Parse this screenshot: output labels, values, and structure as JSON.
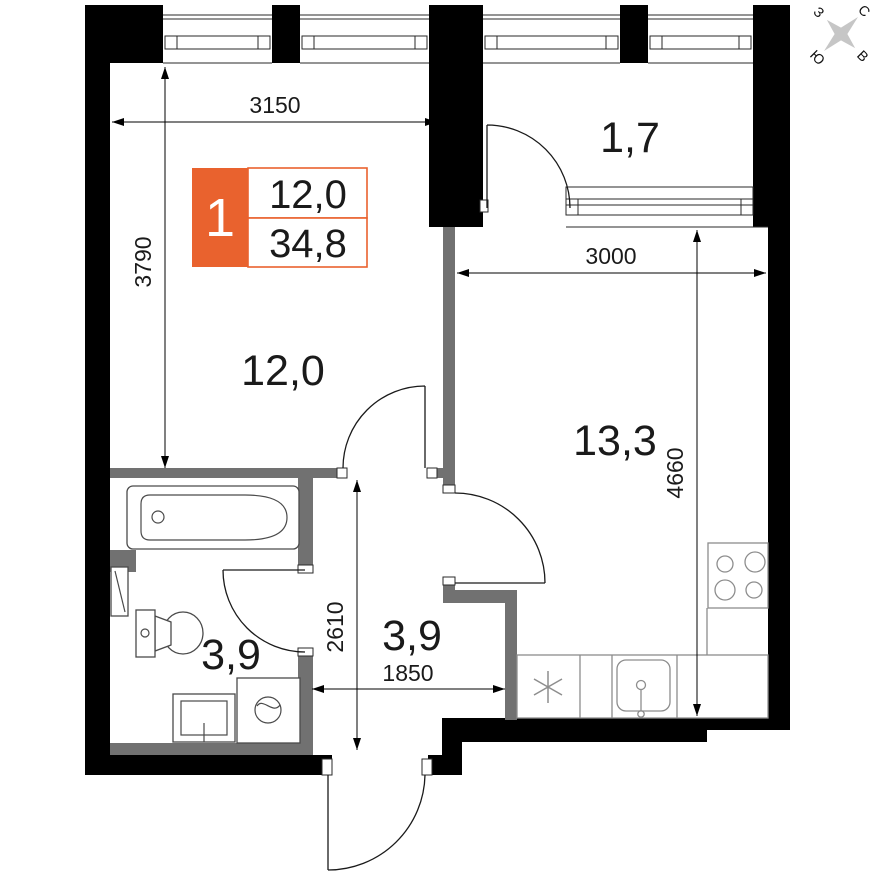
{
  "plan": {
    "legend": {
      "flat_number": "1",
      "living_area": "12,0",
      "total_area": "34,8"
    },
    "rooms": {
      "living": {
        "label": "12,0"
      },
      "kitchen_living": {
        "label": "13,3"
      },
      "loggia": {
        "label": "1,7"
      },
      "bathroom": {
        "label": "3,9"
      },
      "hallway": {
        "label": "3,9"
      }
    },
    "dimensions": {
      "living_width_mm": "3150",
      "living_depth_mm": "3790",
      "kitchen_width_mm": "3000",
      "kitchen_depth_mm": "4660",
      "hallway_depth_mm": "2610",
      "hallway_width_mm": "1850"
    },
    "compass": {
      "north": "С",
      "east": "В",
      "south": "Ю",
      "west": "З"
    },
    "colors": {
      "wall": "#000000",
      "partition": "#717171",
      "accent": "#e9622e",
      "compass_star": "#c6c6c6"
    },
    "icons": {
      "appliance_mark": "asterisk-6-spoke"
    }
  }
}
